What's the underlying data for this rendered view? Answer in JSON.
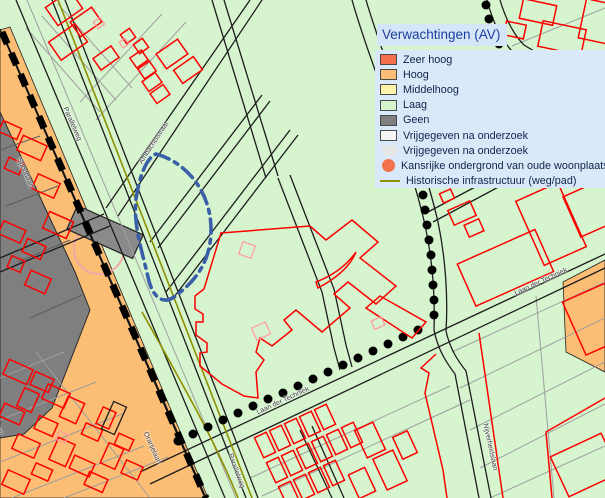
{
  "legend": {
    "title": "Verwachtingen (AV)",
    "items": [
      {
        "label": "Zeer hoog",
        "color": "#f4714c",
        "swatch": "rect"
      },
      {
        "label": "Hoog",
        "color": "#fcbd74",
        "swatch": "rect"
      },
      {
        "label": "Middelhoog",
        "color": "#fdf3ab",
        "swatch": "rect"
      },
      {
        "label": "Laag",
        "color": "#d6f5cf",
        "swatch": "rect"
      },
      {
        "label": "Geen",
        "color": "#7f7f7f",
        "swatch": "rect"
      },
      {
        "label": "Vrijgegeven na onderzoek",
        "color": "#f5f5f5",
        "swatch": "rect"
      },
      {
        "label": "Vrijgegeven na onderzoek",
        "color": "#e7e7e7",
        "swatch": "blob"
      },
      {
        "label": "Kansrijke ondergrond van oude woonplaatsen",
        "color": "#f4714c",
        "swatch": "circle"
      },
      {
        "label": "Historische infrastructuur (weg/pad)",
        "color": "#8f8f00",
        "swatch": "line"
      }
    ]
  },
  "street_labels": [
    {
      "text": "Parallelweg"
    },
    {
      "text": "Spoorlaan"
    },
    {
      "text": "Ambachtsstraat"
    },
    {
      "text": "Laan der Techniek"
    },
    {
      "text": "Laan der Techniek"
    },
    {
      "text": "Nijverheidslaan"
    },
    {
      "text": "Parallelweg"
    },
    {
      "text": "Oranjelaan"
    },
    {
      "text": "Spoorlaan"
    }
  ],
  "colors": {
    "laag_green": "#d6f5cf",
    "hoog_orange": "#fcbd74",
    "zeer_hoog_orange": "#f4714c",
    "geen_gray": "#7f7f7f",
    "building_red": "#fe0000",
    "historic_olive": "#8f8f00",
    "boundary_blue": "#3a5fa8",
    "legend_bg": "#d9e9fa",
    "legend_text": "#0f2348"
  }
}
